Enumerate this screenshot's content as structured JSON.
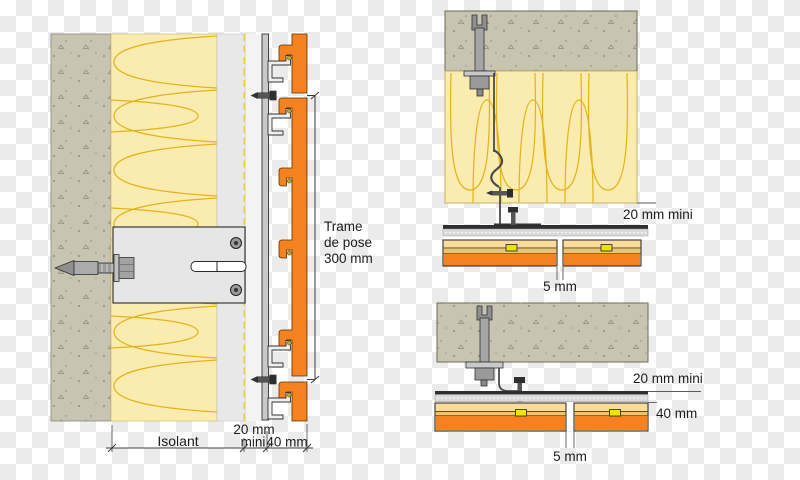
{
  "palette": {
    "orange": "#F58220",
    "insulation_fill": "#FAEBAE",
    "insulation_line": "#E2B31E",
    "concrete_fill": "#C8C4B2",
    "render_grey": "#E8E8E8",
    "air_gap": "#F3F3F3",
    "rail_grey": "#C9C9C9",
    "rail_dark": "#2F2F2F",
    "rail_band": "#DADADA",
    "dashed_yellow": "#EDD33C",
    "clip_yellow": "#EFE400",
    "panel_tan": "#F9DC9A",
    "panel_band": "#EFC36B",
    "bracket_grey": "#E6E6E6",
    "clip_grey": "#EFEFEF"
  },
  "left_section": {
    "trame_line1": "Trame",
    "trame_line2": "de pose",
    "trame_line3": "300 mm",
    "isolant_label": "Isolant",
    "airgap_line1": "20 mm",
    "airgap_line2": "mini",
    "depth_label": "40 mm"
  },
  "top_right_section": {
    "airgap_label": "20 mm mini",
    "joint_label": "5 mm"
  },
  "bottom_right_section": {
    "airgap_label": "20 mm mini",
    "depth_label": "40 mm",
    "joint_label": "5 mm"
  }
}
